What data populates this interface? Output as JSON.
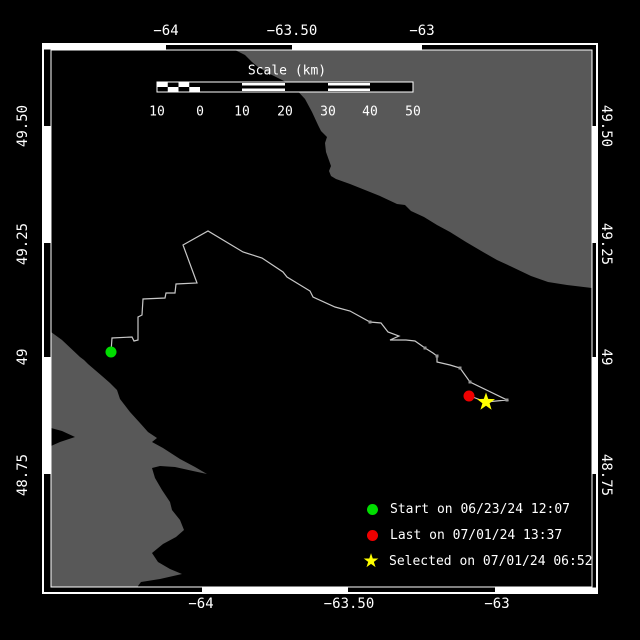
{
  "title": "Animal track map",
  "colors": {
    "background": "#000000",
    "land": "#585858",
    "track": "#c8c8c8",
    "fix_marker": "#999999",
    "frame": "#ffffff",
    "start": "#00dd00",
    "last": "#ee0000",
    "selected": "#ffff00"
  },
  "axes": {
    "top": [
      {
        "label": "−64",
        "x": 166,
        "y": 31
      },
      {
        "label": "−63.50",
        "x": 292,
        "y": 31
      },
      {
        "label": "−63",
        "x": 422,
        "y": 31
      }
    ],
    "bottom": [
      {
        "label": "−64",
        "x": 201,
        "y": 604
      },
      {
        "label": "−63.50",
        "x": 349,
        "y": 604
      },
      {
        "label": "−63",
        "x": 497,
        "y": 604
      }
    ],
    "left": [
      {
        "label": "49.50",
        "x": 23,
        "y": 126
      },
      {
        "label": "49.25",
        "x": 23,
        "y": 244
      },
      {
        "label": "49",
        "x": 23,
        "y": 357
      },
      {
        "label": "48.75",
        "x": 23,
        "y": 475
      }
    ],
    "right": [
      {
        "label": "49.50",
        "x": 606,
        "y": 126
      },
      {
        "label": "49.25",
        "x": 606,
        "y": 244
      },
      {
        "label": "49",
        "x": 606,
        "y": 357
      },
      {
        "label": "48.75",
        "x": 606,
        "y": 475
      }
    ]
  },
  "scalebar": {
    "title": "Scale (km)",
    "title_x": 287,
    "title_y": 71,
    "bar": {
      "x": 157,
      "y": 82,
      "w": 256,
      "h": 10
    },
    "section_edges": [
      157,
      200,
      242,
      285,
      328,
      370,
      413
    ],
    "section_styles": [
      "checker",
      "solid",
      "striped",
      "solid",
      "striped",
      "solid"
    ],
    "ticks": [
      {
        "label": "10",
        "x": 157,
        "y": 112
      },
      {
        "label": "0",
        "x": 200,
        "y": 112
      },
      {
        "label": "10",
        "x": 242,
        "y": 112
      },
      {
        "label": "20",
        "x": 285,
        "y": 112
      },
      {
        "label": "30",
        "x": 328,
        "y": 112
      },
      {
        "label": "40",
        "x": 370,
        "y": 112
      },
      {
        "label": "50",
        "x": 413,
        "y": 112
      }
    ]
  },
  "legend": {
    "items": [
      {
        "marker": "circle",
        "color": "#00dd00",
        "label": "Start on 06/23/24 12:07",
        "x": 372,
        "y": 509
      },
      {
        "marker": "circle",
        "color": "#ee0000",
        "label": "Last on 07/01/24 13:37",
        "x": 372,
        "y": 535
      },
      {
        "marker": "star",
        "glyph": "★",
        "color": "#ffff00",
        "label": "Selected on 07/01/24 06:52",
        "x": 371,
        "y": 561
      }
    ]
  },
  "map": {
    "frame": {
      "outer": [
        43,
        44,
        554,
        549
      ],
      "inner": [
        51,
        50,
        541,
        537
      ]
    },
    "zebra": {
      "top": {
        "edges": [
          43,
          166,
          292,
          422,
          597
        ],
        "colors": [
          "#ffffff",
          "#000000",
          "#ffffff",
          "#000000"
        ]
      },
      "bottom": {
        "edges": [
          43,
          202,
          348,
          495,
          597
        ],
        "colors": [
          "#000000",
          "#ffffff",
          "#000000",
          "#ffffff"
        ]
      },
      "left": {
        "edges": [
          50,
          126,
          243,
          357,
          474,
          587
        ],
        "colors": [
          "#000000",
          "#ffffff",
          "#000000",
          "#ffffff",
          "#000000"
        ]
      },
      "right": {
        "edges": [
          50,
          126,
          243,
          357,
          474,
          587
        ],
        "colors": [
          "#000000",
          "#ffffff",
          "#000000",
          "#ffffff",
          "#000000"
        ]
      }
    },
    "land_polygons": [
      [
        [
          235,
          50
        ],
        [
          245,
          55
        ],
        [
          252,
          62
        ],
        [
          258,
          67
        ],
        [
          270,
          74
        ],
        [
          292,
          85
        ],
        [
          305,
          99
        ],
        [
          312,
          112
        ],
        [
          318,
          125
        ],
        [
          321,
          131
        ],
        [
          327,
          137
        ],
        [
          325,
          143
        ],
        [
          326,
          152
        ],
        [
          331,
          166
        ],
        [
          329,
          171
        ],
        [
          331,
          176
        ],
        [
          336,
          179
        ],
        [
          350,
          184
        ],
        [
          365,
          190
        ],
        [
          380,
          196
        ],
        [
          397,
          204
        ],
        [
          405,
          205
        ],
        [
          411,
          211
        ],
        [
          424,
          217
        ],
        [
          437,
          225
        ],
        [
          450,
          232
        ],
        [
          466,
          242
        ],
        [
          483,
          252
        ],
        [
          497,
          260
        ],
        [
          510,
          266
        ],
        [
          531,
          276
        ],
        [
          548,
          282
        ],
        [
          567,
          285
        ],
        [
          592,
          288
        ],
        [
          592,
          50
        ]
      ],
      [
        [
          51,
          332
        ],
        [
          62,
          340
        ],
        [
          80,
          357
        ],
        [
          84,
          360
        ],
        [
          88,
          364
        ],
        [
          102,
          376
        ],
        [
          110,
          383
        ],
        [
          117,
          390
        ],
        [
          120,
          399
        ],
        [
          130,
          412
        ],
        [
          140,
          423
        ],
        [
          148,
          432
        ],
        [
          157,
          438
        ],
        [
          152,
          442
        ],
        [
          163,
          448
        ],
        [
          180,
          459
        ],
        [
          195,
          467
        ],
        [
          207,
          474
        ],
        [
          193,
          471
        ],
        [
          175,
          467
        ],
        [
          160,
          466
        ],
        [
          152,
          468
        ],
        [
          155,
          478
        ],
        [
          162,
          490
        ],
        [
          170,
          502
        ],
        [
          172,
          510
        ],
        [
          180,
          520
        ],
        [
          184,
          530
        ],
        [
          176,
          537
        ],
        [
          163,
          544
        ],
        [
          152,
          553
        ],
        [
          158,
          562
        ],
        [
          170,
          569
        ],
        [
          182,
          574
        ],
        [
          160,
          579
        ],
        [
          141,
          582
        ],
        [
          138,
          586
        ],
        [
          138,
          592
        ],
        [
          51,
          592
        ],
        [
          51,
          446
        ],
        [
          60,
          442
        ],
        [
          75,
          437
        ],
        [
          62,
          431
        ],
        [
          51,
          428
        ]
      ]
    ],
    "track": [
      [
        111,
        352
      ],
      [
        112,
        338
      ],
      [
        132,
        337
      ],
      [
        134,
        341
      ],
      [
        138,
        340
      ],
      [
        138,
        317
      ],
      [
        142,
        315
      ],
      [
        143,
        299
      ],
      [
        165,
        298
      ],
      [
        166,
        293
      ],
      [
        175,
        293
      ],
      [
        176,
        284
      ],
      [
        197,
        283
      ],
      [
        183,
        245
      ],
      [
        208,
        231
      ],
      [
        243,
        252
      ],
      [
        262,
        258
      ],
      [
        283,
        272
      ],
      [
        287,
        277
      ],
      [
        310,
        291
      ],
      [
        313,
        297
      ],
      [
        335,
        307
      ],
      [
        350,
        311
      ],
      [
        370,
        322
      ],
      [
        381,
        323
      ],
      [
        388,
        332
      ],
      [
        399,
        336
      ],
      [
        390,
        340
      ],
      [
        406,
        340
      ],
      [
        415,
        341
      ],
      [
        425,
        348
      ],
      [
        433,
        353
      ],
      [
        437,
        356
      ],
      [
        437,
        362
      ],
      [
        450,
        365
      ],
      [
        460,
        368
      ],
      [
        470,
        382
      ],
      [
        507,
        400
      ],
      [
        486,
        402
      ],
      [
        470,
        396
      ]
    ],
    "fix_markers": [
      [
        370,
        322
      ],
      [
        425,
        348
      ],
      [
        437,
        356
      ],
      [
        460,
        368
      ],
      [
        470,
        382
      ],
      [
        507,
        400
      ]
    ],
    "start_point": {
      "x": 111,
      "y": 352,
      "r": 5.5
    },
    "last_point": {
      "x": 469,
      "y": 396,
      "r": 5.5
    },
    "selected_point": {
      "x": 486,
      "y": 402,
      "r_outer": 9.5,
      "r_inner": 3.8
    }
  }
}
